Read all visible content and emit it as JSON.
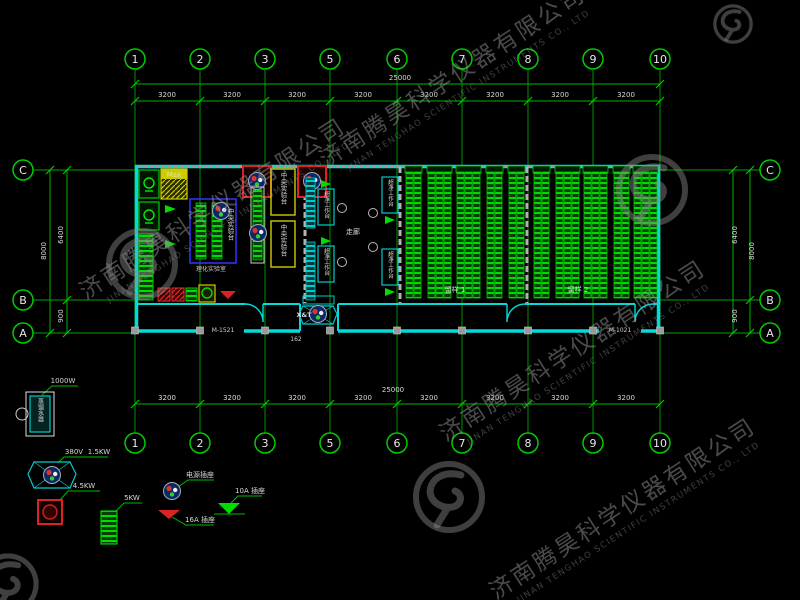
{
  "watermark": {
    "company_cn": "济南腾昊科学仪器有限公司",
    "company_en": "JINAN TENGHAO SCIENTIFIC INSTRUMENTS CO., LTD"
  },
  "grid": {
    "cols": [
      "1",
      "2",
      "3",
      "5",
      "6",
      "7",
      "8",
      "9",
      "10"
    ],
    "rows": [
      "C",
      "B",
      "A"
    ],
    "total_width": "25000",
    "total_height": "8000",
    "bays": [
      "3200",
      "3200",
      "3200",
      "3200",
      "3200",
      "3200",
      "3200",
      "3200"
    ],
    "row_segs": [
      "6400",
      "900"
    ]
  },
  "plan": {
    "room_left_label": "理化实验室",
    "central_bench": "中央实验台",
    "side_bench": "中央实验台",
    "clean_bench": "超净工作台",
    "corridor": "走廊",
    "ms": "MS",
    "entry": "X&T",
    "max": "Max",
    "door_left": "M-1521",
    "door_right": "M-1021",
    "room1": "留样 1",
    "room2": "留样 2",
    "note": "162"
  },
  "legend": {
    "distiller": "蒸馏水器",
    "distiller_power": "1000W",
    "volt": "380V",
    "kw15": "1.5KW",
    "kw45": "4.5KW",
    "kw5": "5KW",
    "outlet_power": "电源插座",
    "outlet_16a": "16A 插座",
    "outlet_10a": "10A 插座"
  }
}
